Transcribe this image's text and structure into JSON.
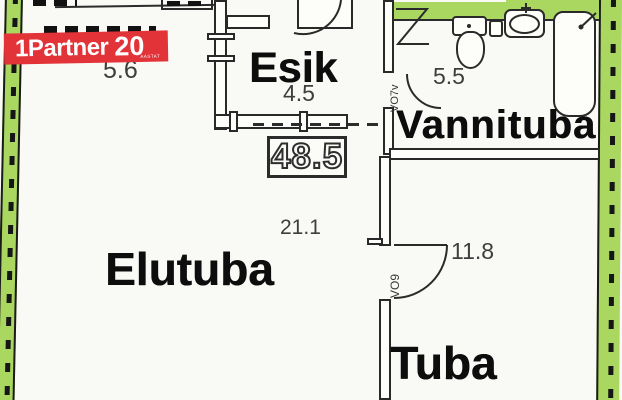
{
  "plan": {
    "total_area": "48.5",
    "rooms": {
      "kitchen": {
        "area": "5.6"
      },
      "hallway": {
        "label": "Esik",
        "area": "4.5"
      },
      "bathroom": {
        "label": "Vannituba",
        "area": "5.5"
      },
      "living_room": {
        "label": "Elutuba",
        "area": "21.1"
      },
      "bedroom": {
        "label": "Tuba",
        "area": "11.8"
      }
    },
    "door_codes": {
      "bathroom_door": "VO7v",
      "bedroom_door": "VO9"
    }
  },
  "logo": {
    "brand": "1Partner",
    "anniversary": "20",
    "anniversary_caption": "AASTAT"
  },
  "colors": {
    "wall_highlight_green": "#a9d75f",
    "logo_red": "#e23339",
    "plan_line": "#2a2a2a",
    "area_text": "#3e3e3e",
    "label_text": "#0d0d0d",
    "paper": "#f9f9f6"
  }
}
